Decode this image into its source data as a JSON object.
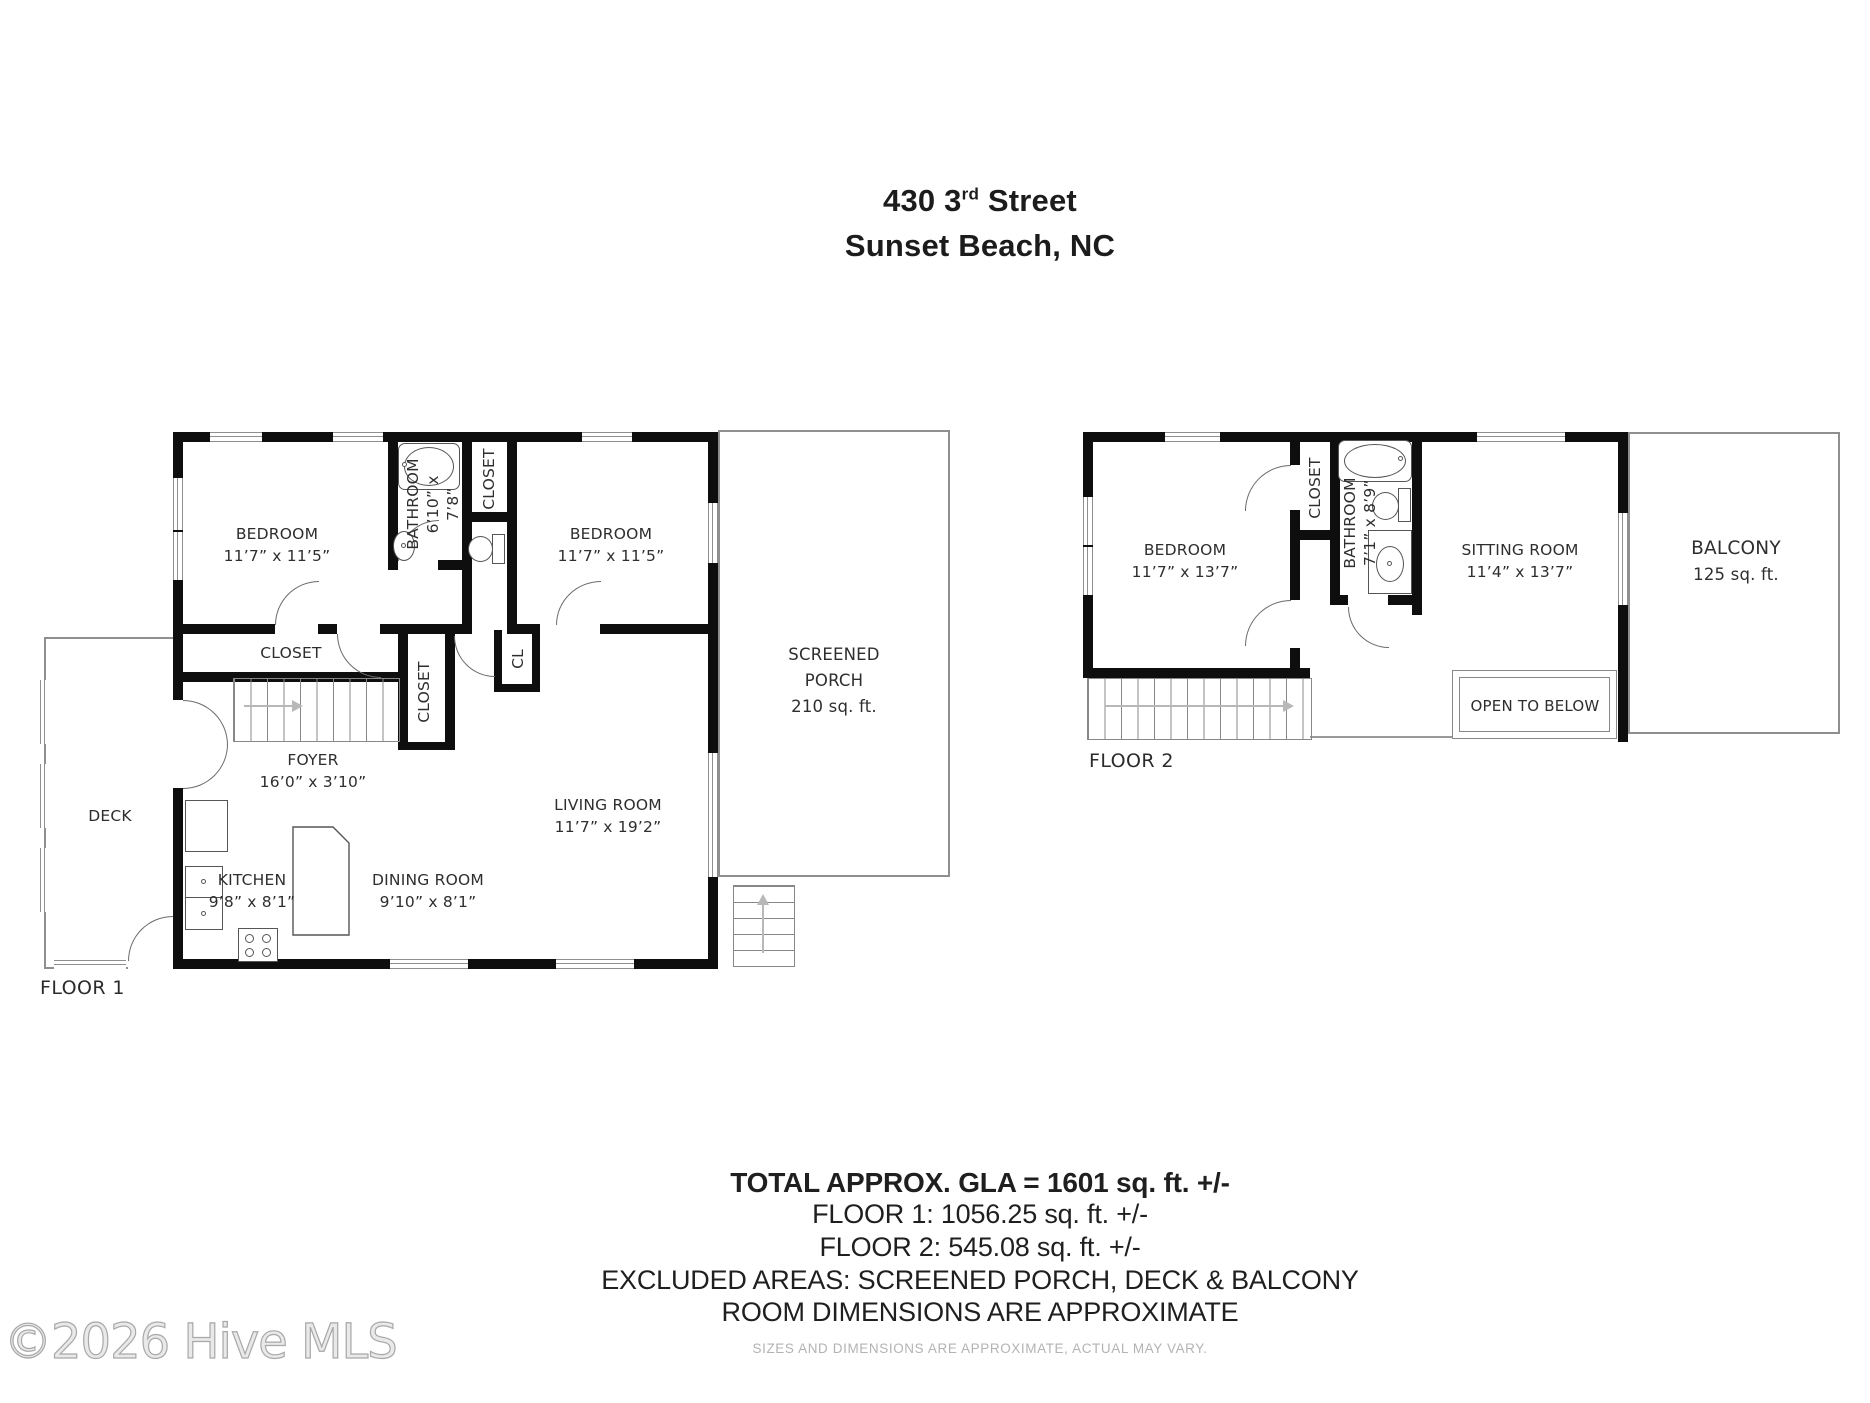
{
  "title": {
    "address_num": "430 3",
    "address_sup": "rd",
    "address_rest": " Street",
    "city": "Sunset Beach, NC"
  },
  "floor1": {
    "caption": "FLOOR 1",
    "deck_label": "DECK",
    "bedroom_left_name": "BEDROOM",
    "bedroom_left_dims": "11’7” x 11’5”",
    "bedroom_right_name": "BEDROOM",
    "bedroom_right_dims": "11’7” x 11’5”",
    "bathroom_name": "BATHROOM",
    "bathroom_dims1": "6’10” x",
    "bathroom_dims2": "7’8”",
    "closet_top_label": "CLOSET",
    "closet_long_label": "CLOSET",
    "closet_mid_label": "CLOSET",
    "closet_small_label": "CL",
    "foyer_name": "FOYER",
    "foyer_dims": "16’0” x 3’10”",
    "living_name": "LIVING ROOM",
    "living_dims": "11’7” x 19’2”",
    "kitchen_name": "KITCHEN",
    "kitchen_dims": "9’8” x 8’1”",
    "dining_name": "DINING ROOM",
    "dining_dims": "9’10” x 8’1”",
    "porch_line1": "SCREENED",
    "porch_line2": "PORCH",
    "porch_line3": "210 sq. ft."
  },
  "floor2": {
    "caption": "FLOOR 2",
    "bedroom_name": "BEDROOM",
    "bedroom_dims": "11’7” x 13’7”",
    "closet_label": "CLOSET",
    "bathroom_name": "BATHROOM",
    "bathroom_dims": "7’1” x 8’9”",
    "sitting_name": "SITTING ROOM",
    "sitting_dims": "11’4” x 13’7”",
    "balcony_name": "BALCONY",
    "balcony_dims": "125 sq. ft.",
    "open_below_label": "OPEN TO BELOW"
  },
  "summary": {
    "gla": "TOTAL APPROX. GLA = 1601 sq. ft. +/-",
    "floor1_area": "FLOOR 1: 1056.25 sq. ft. +/-",
    "floor2_area": "FLOOR 2: 545.08 sq. ft. +/-",
    "excluded": "EXCLUDED AREAS: SCREENED PORCH, DECK & BALCONY",
    "note": "ROOM DIMENSIONS ARE APPROXIMATE",
    "disclaimer": "SIZES AND DIMENSIONS ARE APPROXIMATE, ACTUAL MAY VARY."
  },
  "watermark": "©2026 Hive MLS"
}
